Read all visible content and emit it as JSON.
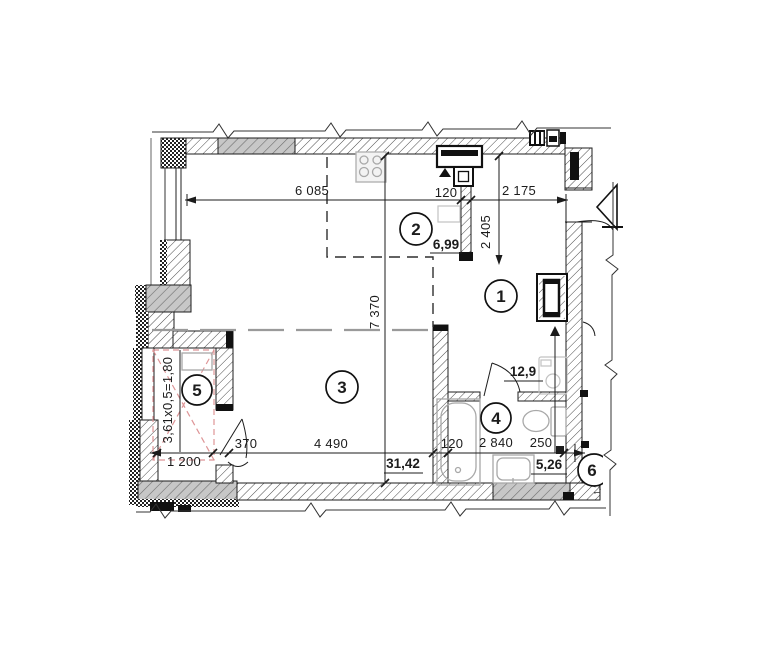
{
  "plan": {
    "title": "apartment floor plan fragment",
    "rooms": [
      {
        "number": "1",
        "area": "12,9"
      },
      {
        "number": "2",
        "area": "6,99"
      },
      {
        "number": "3",
        "area": "31,42"
      },
      {
        "number": "4",
        "area": "5,26"
      },
      {
        "number": "5",
        "area": "3,61x0,5=1,80"
      },
      {
        "number": "6",
        "area": ""
      }
    ],
    "dims": {
      "w6085": "6 085",
      "w120t": "120",
      "w2175": "2 175",
      "h2405": "2 405",
      "h7370": "7 370",
      "b1200": "1 200",
      "b370": "370",
      "b4490": "4 490",
      "b120": "120",
      "b2840": "2 840",
      "b250": "250",
      "edge_note": "1,3"
    },
    "colors": {
      "ink": "#1c1c1c",
      "wall_hatch": "#4a4a4a",
      "concrete_fill": "#c7c7c7",
      "fixture_gray": "#a8a8a8",
      "loggia_x_pink": "#de9597",
      "zone_line_gray": "#9a9a9a"
    }
  }
}
